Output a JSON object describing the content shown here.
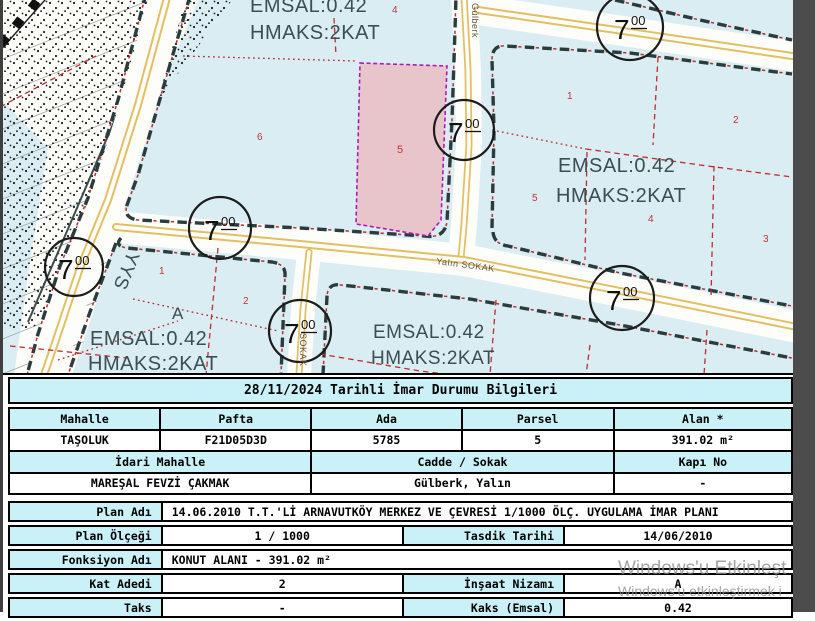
{
  "map": {
    "zoning": {
      "emsal": "EMSAL:0.42",
      "hmaks": "HMAKS:2KAT"
    },
    "marker": {
      "main": "7",
      "sup": "00"
    },
    "streets": {
      "gulberk": "Gülberk",
      "yalin": "Yalın SOKAK",
      "sokak": "SOKAK"
    },
    "area_labels": {
      "yys": "YYS",
      "a": "A"
    },
    "parcel_numbers": {
      "top4": "4",
      "block1_6": "6",
      "subject5": "5",
      "r1": "1",
      "r2": "2",
      "r5": "5",
      "r4": "4",
      "r3": "3",
      "l1": "1",
      "l2": "2"
    },
    "colors": {
      "background": "#d9edf2",
      "subject_parcel_fill": "#e8c5cb",
      "subject_parcel_border": "#b217b2",
      "road_line": "#e2bf62",
      "boundary_dash": "#2c3b3d",
      "parcel_line_red": "#c32a2a"
    }
  },
  "info_table": {
    "title": "28/11/2024 Tarihli İmar Durumu Bilgileri",
    "headers": [
      "Mahalle",
      "Pafta",
      "Ada",
      "Parsel",
      "Alan *"
    ],
    "values": [
      "TAŞOLUK",
      "F21D05D3D",
      "5785",
      "5",
      "391.02 m²"
    ],
    "headers2": [
      "İdari Mahalle",
      "Cadde / Sokak",
      "Kapı No"
    ],
    "values2": [
      "MAREŞAL FEVZİ ÇAKMAK",
      "Gülberk, Yalın",
      "-"
    ]
  },
  "plan_table": {
    "r1": {
      "label": "Plan Adı",
      "value": "14.06.2010 T.T.'Lİ ARNAVUTKÖY MERKEZ VE ÇEVRESİ 1/1000 ÖLÇ. UYGULAMA İMAR PLANI"
    },
    "r2": {
      "label": "Plan Ölçeği",
      "value": "1 / 1000",
      "label2": "Tasdik Tarihi",
      "value2": "14/06/2010"
    },
    "r3": {
      "label": "Fonksiyon Adı",
      "value": "KONUT ALANI  - 391.02 m²"
    },
    "r4": {
      "label": "Kat Adedi",
      "value": "2",
      "label2": "İnşaat Nizamı",
      "value2": "A"
    },
    "r5": {
      "label": "Taks",
      "value": "-",
      "label2": "Kaks (Emsal)",
      "value2": "0.42"
    }
  },
  "watermark": {
    "line1": "Windows'u Etkinleşt",
    "line2": "Windows'u etkinleştirmek i"
  }
}
